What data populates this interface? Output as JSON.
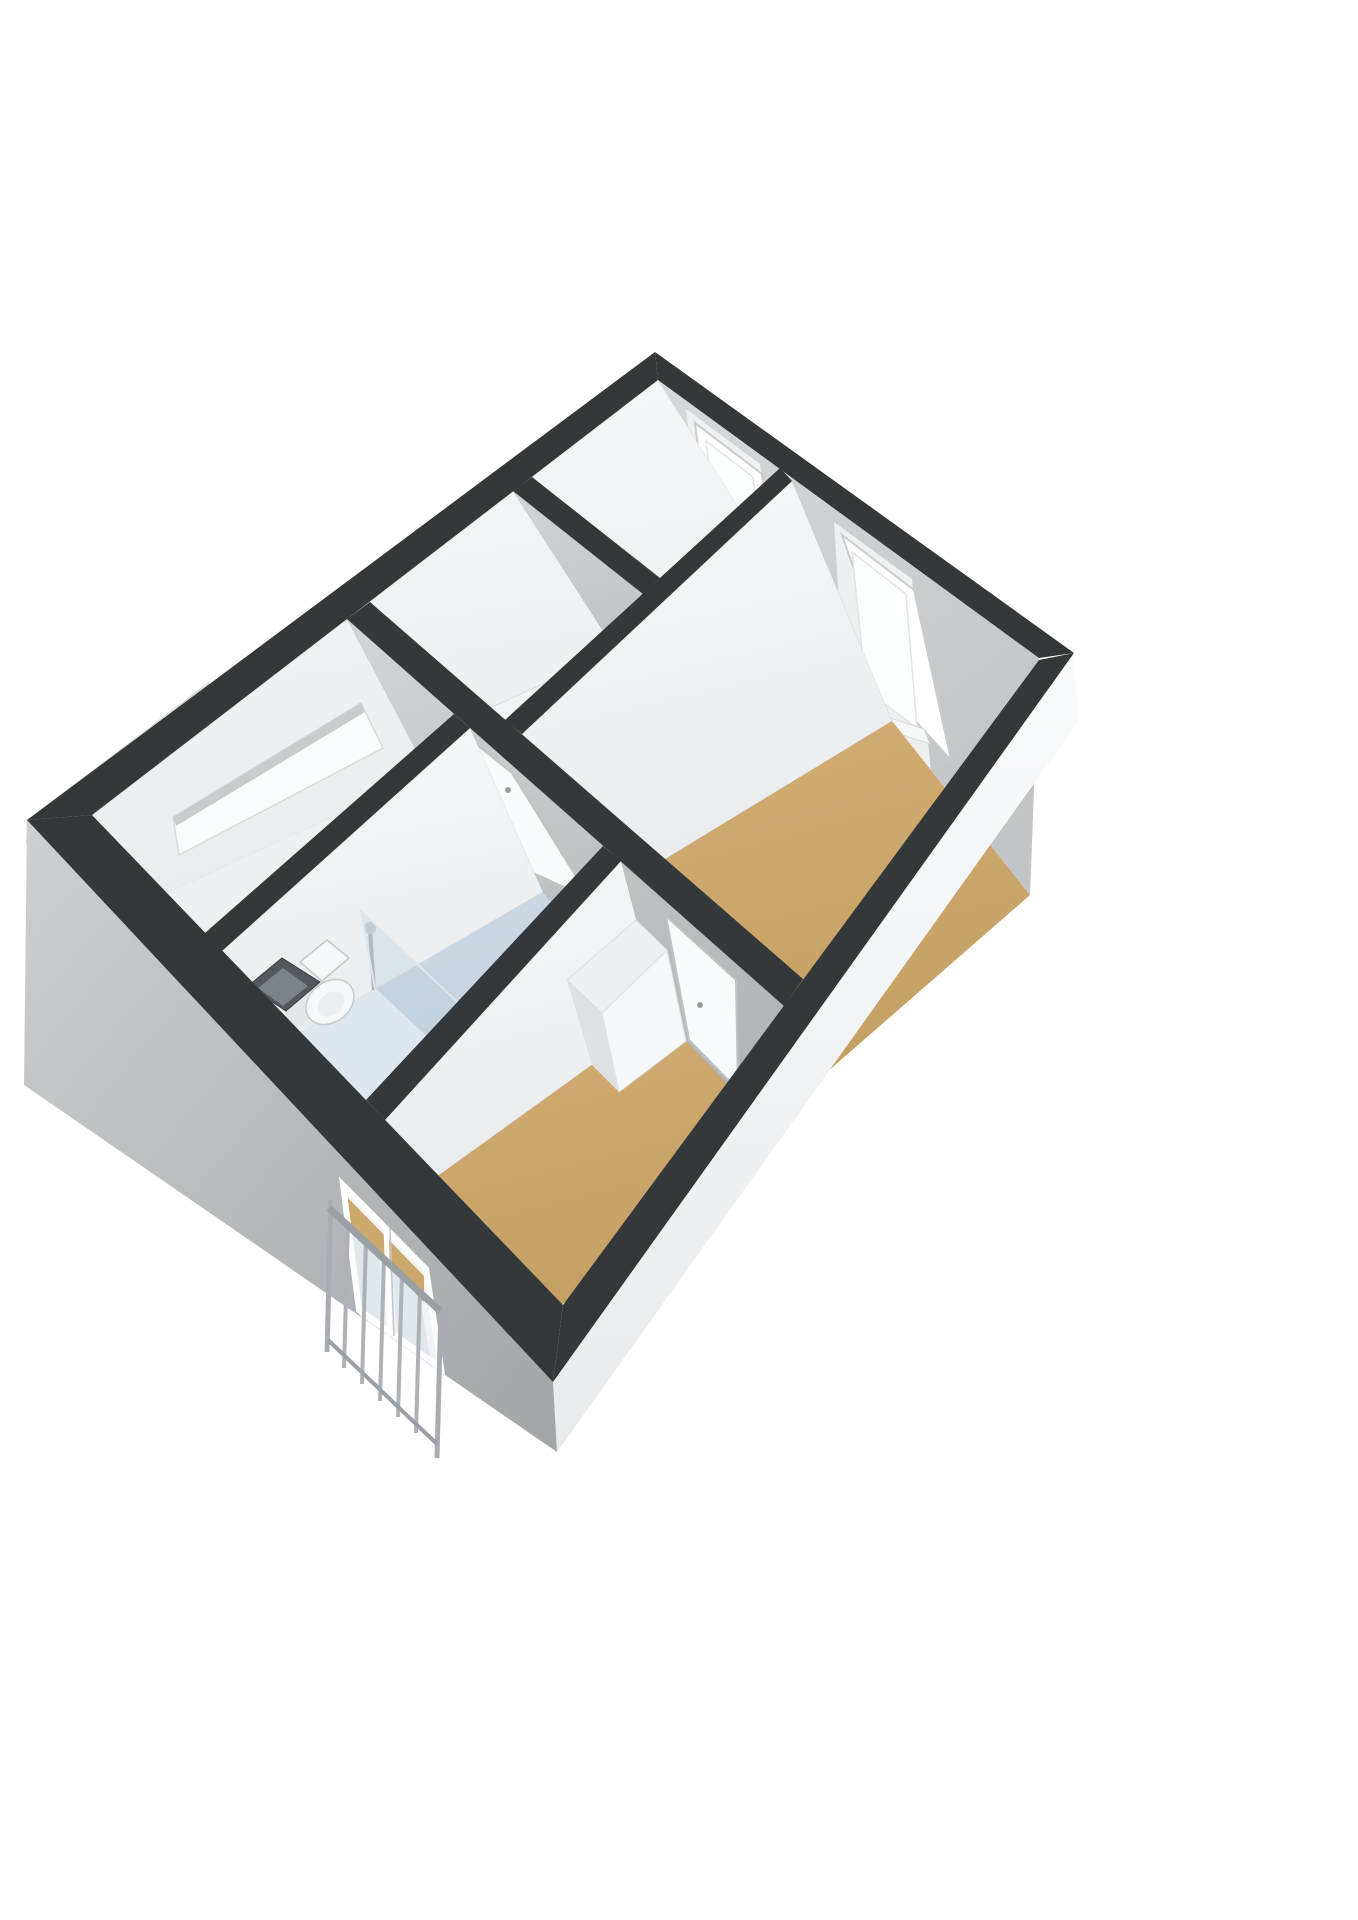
{
  "title": "3D floor plan render — upper floor, bird's-eye axonometric view on white background",
  "colors": {
    "background": "#ffffff",
    "wall_top": "#35383b",
    "wall_face_light": "#f4f5f6",
    "wall_face_shadow": "#c3c6c9",
    "wall_outer_gray": "#b7babd",
    "floor_wood": "#cda86d",
    "floor_bathroom": "#c8d4e2",
    "floor_shower": "#dfe7ee",
    "floor_landing": "#eff0f2",
    "window_glass": "#fdfefe",
    "chrome": "#a9adb1",
    "wood_baluster": "#b98f4e"
  },
  "scene": {
    "kind": "3d-floorplan",
    "projection": "perspective bird's-eye",
    "walls_cut": true,
    "text_labels": []
  },
  "rooms": [
    {
      "id": "bedroom-top",
      "kind": "bedroom",
      "floor": "wood",
      "windows": 1
    },
    {
      "id": "bedroom-large",
      "kind": "bedroom",
      "floor": "wood",
      "windows": 1
    },
    {
      "id": "bedroom-front",
      "kind": "bedroom",
      "floor": "wood",
      "features": [
        "balcony-door-opening",
        "duct-box"
      ]
    },
    {
      "id": "bathroom",
      "kind": "bathroom",
      "floor": "bathroom-blue",
      "fixtures": [
        "toilet",
        "washbasin",
        "vanity-unit",
        "walk-in-shower",
        "glass-screen"
      ]
    },
    {
      "id": "landing",
      "kind": "hall-landing",
      "floor": "light",
      "features": [
        "staircase",
        "stairwell-opening",
        "railing"
      ]
    },
    {
      "id": "storage",
      "kind": "closet",
      "floor": "light",
      "features": [
        "recessed-slit-window"
      ]
    }
  ],
  "windows": [
    {
      "id": "window-1",
      "wall": "back-right",
      "room": "bedroom-top"
    },
    {
      "id": "window-2",
      "wall": "back-right",
      "room": "bedroom-large"
    },
    {
      "id": "slit-window",
      "wall": "back-left",
      "room": "storage"
    },
    {
      "id": "balcony-door",
      "wall": "front-left",
      "room": "bedroom-front",
      "railing": "french-balcony"
    }
  ],
  "stairs": {
    "visible_treads": 4,
    "stairwell": "open to floor below",
    "railing": "wood balusters with gray handrail",
    "stringer": "sawtooth"
  }
}
